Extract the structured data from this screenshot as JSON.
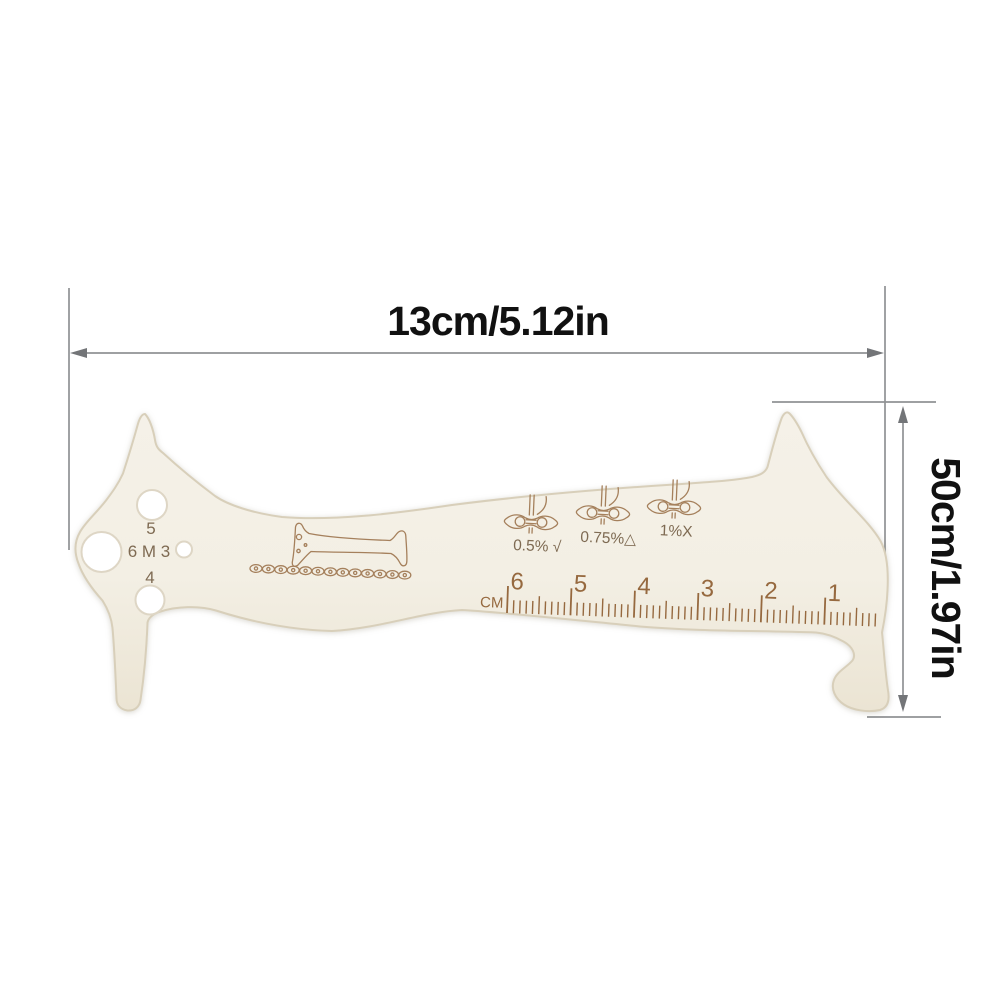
{
  "page": {
    "background": "#ffffff"
  },
  "dimensions": {
    "width_label": "13cm/5.12in",
    "height_label": "50cm/1.97in"
  },
  "tool": {
    "hole_rows": [
      "5",
      "6 M 3",
      "4"
    ],
    "wear_marks": [
      "0.5% √",
      "0.75%△",
      "1%X"
    ],
    "ruler": {
      "unit_label": "CM",
      "numbers": [
        6,
        5,
        4,
        3,
        2,
        1
      ]
    }
  },
  "colors": {
    "tool_body": "#f4f0e6",
    "tool_body_shade": "#ece5d4",
    "tool_edge": "#d8cfba",
    "etch_ink": "#a5805c",
    "ruler_ink": "#96693f",
    "label_ink": "#7e6a52",
    "dimension_line": "#909294",
    "dimension_arrow": "#737578",
    "dimension_text": "#111111"
  }
}
